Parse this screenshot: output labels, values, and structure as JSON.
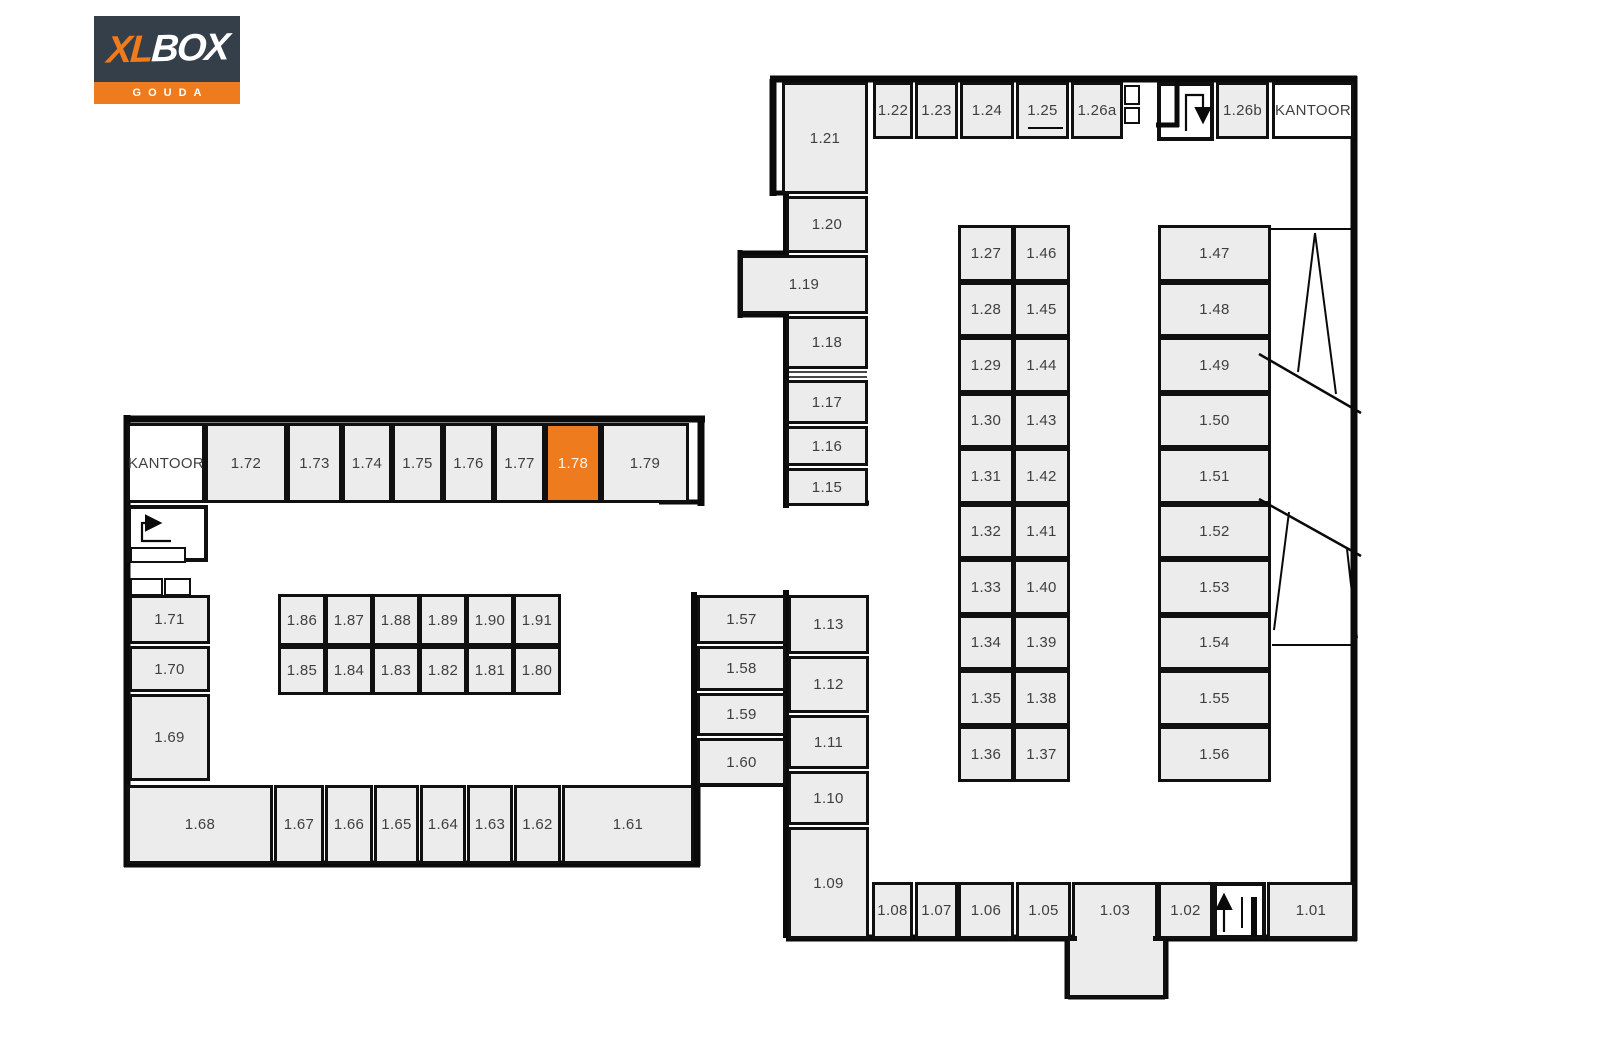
{
  "logo": {
    "xl": "XL",
    "box": "BOX",
    "city": "GOUDA"
  },
  "colors": {
    "highlight": "#ee7b1e",
    "unit_fill": "#ececec",
    "wall": "#0a0a0a",
    "logo_navy": "#353f4a",
    "label": "#3f3f3f"
  },
  "selected_unit": "1.78",
  "map": {
    "rooms": [
      {
        "label": "KANTOOR",
        "name": "kantoor-left",
        "x": 127,
        "y": 423,
        "w": 78,
        "h": 80,
        "fill": "office"
      },
      {
        "label": "1.72",
        "x": 205,
        "y": 423,
        "w": 82,
        "h": 80
      },
      {
        "label": "1.73",
        "x": 287,
        "y": 423,
        "w": 55,
        "h": 80
      },
      {
        "label": "1.74",
        "x": 342,
        "y": 423,
        "w": 50,
        "h": 80
      },
      {
        "label": "1.75",
        "x": 392,
        "y": 423,
        "w": 51,
        "h": 80
      },
      {
        "label": "1.76",
        "x": 443,
        "y": 423,
        "w": 51,
        "h": 80
      },
      {
        "label": "1.77",
        "x": 494,
        "y": 423,
        "w": 51,
        "h": 80
      },
      {
        "label": "1.78",
        "x": 545,
        "y": 423,
        "w": 56,
        "h": 80,
        "fill": "highlight"
      },
      {
        "label": "1.79",
        "x": 601,
        "y": 423,
        "w": 88,
        "h": 80
      },
      {
        "label": "",
        "name": "stairwell-left",
        "x": 127,
        "y": 505,
        "w": 81,
        "h": 57,
        "fill": "stair",
        "cls": "stairbox"
      },
      {
        "label": "",
        "name": "stair-landing-left",
        "x": 130,
        "y": 547,
        "w": 56,
        "h": 16,
        "fill": "stair",
        "cls": "thin"
      },
      {
        "label": "",
        "name": "closet-left-a",
        "x": 130,
        "y": 578,
        "w": 33,
        "h": 18,
        "fill": "stair",
        "cls": "thin"
      },
      {
        "label": "",
        "name": "closet-left-b",
        "x": 164,
        "y": 578,
        "w": 27,
        "h": 18,
        "fill": "stair",
        "cls": "thin"
      },
      {
        "label": "1.71",
        "x": 129,
        "y": 595,
        "w": 81,
        "h": 49
      },
      {
        "label": "1.70",
        "x": 129,
        "y": 646,
        "w": 81,
        "h": 46
      },
      {
        "label": "1.69",
        "x": 129,
        "y": 694,
        "w": 81,
        "h": 87
      },
      {
        "label": "1.68",
        "x": 127,
        "y": 785,
        "w": 146,
        "h": 79
      },
      {
        "label": "1.67",
        "x": 274,
        "y": 785,
        "w": 50,
        "h": 79
      },
      {
        "label": "1.66",
        "x": 325,
        "y": 785,
        "w": 48,
        "h": 79
      },
      {
        "label": "1.65",
        "x": 374,
        "y": 785,
        "w": 45,
        "h": 79
      },
      {
        "label": "1.64",
        "x": 420,
        "y": 785,
        "w": 46,
        "h": 79
      },
      {
        "label": "1.63",
        "x": 467,
        "y": 785,
        "w": 46,
        "h": 79
      },
      {
        "label": "1.62",
        "x": 514,
        "y": 785,
        "w": 47,
        "h": 79
      },
      {
        "label": "1.61",
        "x": 562,
        "y": 785,
        "w": 132,
        "h": 79
      },
      {
        "label": "1.86",
        "x": 278,
        "y": 594,
        "w": 48,
        "h": 52
      },
      {
        "label": "1.87",
        "x": 325,
        "y": 594,
        "w": 48,
        "h": 52
      },
      {
        "label": "1.88",
        "x": 372,
        "y": 594,
        "w": 48,
        "h": 52
      },
      {
        "label": "1.89",
        "x": 419,
        "y": 594,
        "w": 48,
        "h": 52
      },
      {
        "label": "1.90",
        "x": 466,
        "y": 594,
        "w": 48,
        "h": 52
      },
      {
        "label": "1.91",
        "x": 513,
        "y": 594,
        "w": 48,
        "h": 52
      },
      {
        "label": "1.85",
        "x": 278,
        "y": 646,
        "w": 48,
        "h": 49
      },
      {
        "label": "1.84",
        "x": 325,
        "y": 646,
        "w": 48,
        "h": 49
      },
      {
        "label": "1.83",
        "x": 372,
        "y": 646,
        "w": 48,
        "h": 49
      },
      {
        "label": "1.82",
        "x": 419,
        "y": 646,
        "w": 48,
        "h": 49
      },
      {
        "label": "1.81",
        "x": 466,
        "y": 646,
        "w": 48,
        "h": 49
      },
      {
        "label": "1.80",
        "x": 513,
        "y": 646,
        "w": 48,
        "h": 49
      },
      {
        "label": "1.57",
        "x": 697,
        "y": 595,
        "w": 89,
        "h": 49
      },
      {
        "label": "1.58",
        "x": 697,
        "y": 646,
        "w": 89,
        "h": 45
      },
      {
        "label": "1.59",
        "x": 697,
        "y": 693,
        "w": 89,
        "h": 43
      },
      {
        "label": "1.60",
        "x": 697,
        "y": 738,
        "w": 89,
        "h": 48
      },
      {
        "label": "1.13",
        "x": 788,
        "y": 595,
        "w": 81,
        "h": 59
      },
      {
        "label": "1.12",
        "x": 788,
        "y": 656,
        "w": 81,
        "h": 57
      },
      {
        "label": "1.11",
        "x": 788,
        "y": 715,
        "w": 81,
        "h": 54
      },
      {
        "label": "1.10",
        "x": 788,
        "y": 771,
        "w": 81,
        "h": 54
      },
      {
        "label": "1.09",
        "x": 788,
        "y": 827,
        "w": 81,
        "h": 112
      },
      {
        "label": "1.21",
        "x": 782,
        "y": 82,
        "w": 86,
        "h": 112
      },
      {
        "label": "1.20",
        "x": 786,
        "y": 196,
        "w": 82,
        "h": 57
      },
      {
        "label": "1.19",
        "x": 740,
        "y": 255,
        "w": 128,
        "h": 59
      },
      {
        "label": "1.18",
        "x": 786,
        "y": 316,
        "w": 82,
        "h": 53
      },
      {
        "label": "1.17",
        "x": 786,
        "y": 380,
        "w": 82,
        "h": 44
      },
      {
        "label": "1.16",
        "x": 786,
        "y": 426,
        "w": 82,
        "h": 40
      },
      {
        "label": "1.15",
        "x": 786,
        "y": 468,
        "w": 82,
        "h": 38
      },
      {
        "label": "1.22",
        "x": 873,
        "y": 82,
        "w": 40,
        "h": 57
      },
      {
        "label": "1.23",
        "x": 915,
        "y": 82,
        "w": 43,
        "h": 57
      },
      {
        "label": "1.24",
        "x": 960,
        "y": 82,
        "w": 54,
        "h": 57
      },
      {
        "label": "1.25",
        "x": 1016,
        "y": 82,
        "w": 53,
        "h": 57
      },
      {
        "label": "1.26a",
        "x": 1071,
        "y": 82,
        "w": 52,
        "h": 57
      },
      {
        "label": "",
        "name": "shaft-top-a",
        "x": 1124,
        "y": 85,
        "w": 16,
        "h": 20,
        "fill": "stair",
        "cls": "thin"
      },
      {
        "label": "",
        "name": "shaft-top-b",
        "x": 1124,
        "y": 107,
        "w": 16,
        "h": 17,
        "fill": "stair",
        "cls": "thin"
      },
      {
        "label": "",
        "name": "stairwell-top",
        "x": 1157,
        "y": 82,
        "w": 57,
        "h": 59,
        "fill": "stair",
        "cls": "stairbox"
      },
      {
        "label": "1.26b",
        "x": 1216,
        "y": 82,
        "w": 53,
        "h": 57
      },
      {
        "label": "KANTOOR",
        "name": "kantoor-right",
        "x": 1272,
        "y": 82,
        "w": 82,
        "h": 57,
        "fill": "office"
      },
      {
        "label": "1.27",
        "x": 958,
        "y": 225,
        "w": 56,
        "h": 57
      },
      {
        "label": "1.28",
        "x": 958,
        "y": 282,
        "w": 56,
        "h": 55
      },
      {
        "label": "1.29",
        "x": 958,
        "y": 337,
        "w": 56,
        "h": 56
      },
      {
        "label": "1.30",
        "x": 958,
        "y": 393,
        "w": 56,
        "h": 55
      },
      {
        "label": "1.31",
        "x": 958,
        "y": 448,
        "w": 56,
        "h": 56
      },
      {
        "label": "1.32",
        "x": 958,
        "y": 504,
        "w": 56,
        "h": 55
      },
      {
        "label": "1.33",
        "x": 958,
        "y": 559,
        "w": 56,
        "h": 56
      },
      {
        "label": "1.34",
        "x": 958,
        "y": 615,
        "w": 56,
        "h": 55
      },
      {
        "label": "1.35",
        "x": 958,
        "y": 670,
        "w": 56,
        "h": 56
      },
      {
        "label": "1.36",
        "x": 958,
        "y": 726,
        "w": 56,
        "h": 56
      },
      {
        "label": "1.46",
        "x": 1013,
        "y": 225,
        "w": 57,
        "h": 57
      },
      {
        "label": "1.45",
        "x": 1013,
        "y": 282,
        "w": 57,
        "h": 55
      },
      {
        "label": "1.44",
        "x": 1013,
        "y": 337,
        "w": 57,
        "h": 56
      },
      {
        "label": "1.43",
        "x": 1013,
        "y": 393,
        "w": 57,
        "h": 55
      },
      {
        "label": "1.42",
        "x": 1013,
        "y": 448,
        "w": 57,
        "h": 56
      },
      {
        "label": "1.41",
        "x": 1013,
        "y": 504,
        "w": 57,
        "h": 55
      },
      {
        "label": "1.40",
        "x": 1013,
        "y": 559,
        "w": 57,
        "h": 56
      },
      {
        "label": "1.39",
        "x": 1013,
        "y": 615,
        "w": 57,
        "h": 55
      },
      {
        "label": "1.38",
        "x": 1013,
        "y": 670,
        "w": 57,
        "h": 56
      },
      {
        "label": "1.37",
        "x": 1013,
        "y": 726,
        "w": 57,
        "h": 56
      },
      {
        "label": "1.47",
        "x": 1158,
        "y": 225,
        "w": 113,
        "h": 57
      },
      {
        "label": "1.48",
        "x": 1158,
        "y": 282,
        "w": 113,
        "h": 55
      },
      {
        "label": "1.49",
        "x": 1158,
        "y": 337,
        "w": 113,
        "h": 56
      },
      {
        "label": "1.50",
        "x": 1158,
        "y": 393,
        "w": 113,
        "h": 55
      },
      {
        "label": "1.51",
        "x": 1158,
        "y": 448,
        "w": 113,
        "h": 56
      },
      {
        "label": "1.52",
        "x": 1158,
        "y": 504,
        "w": 113,
        "h": 55
      },
      {
        "label": "1.53",
        "x": 1158,
        "y": 559,
        "w": 113,
        "h": 56
      },
      {
        "label": "1.54",
        "x": 1158,
        "y": 615,
        "w": 113,
        "h": 55
      },
      {
        "label": "1.55",
        "x": 1158,
        "y": 670,
        "w": 113,
        "h": 56
      },
      {
        "label": "1.56",
        "x": 1158,
        "y": 726,
        "w": 113,
        "h": 56
      },
      {
        "label": "1.08",
        "x": 872,
        "y": 882,
        "w": 41,
        "h": 57
      },
      {
        "label": "1.07",
        "x": 915,
        "y": 882,
        "w": 43,
        "h": 57
      },
      {
        "label": "1.06",
        "x": 958,
        "y": 882,
        "w": 56,
        "h": 57
      },
      {
        "label": "1.05",
        "x": 1016,
        "y": 882,
        "w": 55,
        "h": 57
      },
      {
        "label": "",
        "name": "room-1-03-annex",
        "x": 1067,
        "y": 938,
        "w": 99,
        "h": 60
      },
      {
        "label": "1.03",
        "x": 1072,
        "y": 882,
        "w": 86,
        "h": 57
      },
      {
        "label": "",
        "name": "room-1-03-join",
        "x": 1077,
        "y": 930,
        "w": 76,
        "h": 14,
        "fill": "patch",
        "cls": "patch"
      },
      {
        "label": "1.02",
        "x": 1158,
        "y": 882,
        "w": 55,
        "h": 57
      },
      {
        "label": "",
        "name": "stairwell-bottom",
        "x": 1213,
        "y": 882,
        "w": 53,
        "h": 57,
        "fill": "stair",
        "cls": "stairbox"
      },
      {
        "label": "1.01",
        "x": 1267,
        "y": 882,
        "w": 88,
        "h": 57
      }
    ],
    "walls": [
      [
        127,
        419,
        705,
        419,
        7
      ],
      [
        127,
        415,
        127,
        867,
        7
      ],
      [
        124,
        864,
        700,
        864,
        7
      ],
      [
        701,
        419,
        701,
        506,
        7
      ],
      [
        659,
        502,
        703,
        502,
        5
      ],
      [
        697,
        782,
        697,
        866,
        7
      ],
      [
        694,
        592,
        694,
        787,
        6
      ],
      [
        693,
        784,
        789,
        784,
        6
      ],
      [
        770,
        79,
        1357,
        79,
        7
      ],
      [
        1354,
        76,
        1354,
        941,
        7
      ],
      [
        786,
        938,
        1357,
        938,
        7
      ],
      [
        1068,
        936,
        1068,
        999,
        7
      ],
      [
        1068,
        996,
        1165,
        996,
        7
      ],
      [
        1165,
        936,
        1165,
        999,
        7
      ],
      [
        773,
        79,
        773,
        196,
        7
      ],
      [
        772,
        193,
        788,
        193,
        5
      ],
      [
        786,
        190,
        786,
        508,
        6
      ],
      [
        786,
        590,
        786,
        938,
        6
      ],
      [
        740,
        253,
        786,
        253,
        5
      ],
      [
        740,
        250,
        740,
        318,
        5
      ],
      [
        740,
        315,
        786,
        315,
        5
      ],
      [
        786,
        503,
        869,
        503,
        5
      ]
    ],
    "overlay_lines": [
      [
        787,
        372,
        867,
        372,
        1.6
      ],
      [
        787,
        377,
        867,
        377,
        1.6
      ],
      [
        1028,
        128,
        1063,
        128,
        2
      ],
      [
        1271,
        229,
        1353,
        229,
        2
      ],
      [
        1315,
        233,
        1298,
        372,
        2
      ],
      [
        1315,
        233,
        1336,
        394,
        2
      ],
      [
        1259,
        354,
        1361,
        413,
        2.5
      ],
      [
        1259,
        499,
        1361,
        556,
        2.5
      ],
      [
        1289,
        512,
        1274,
        630,
        2
      ],
      [
        1347,
        549,
        1357,
        638,
        2
      ],
      [
        1272,
        645,
        1354,
        645,
        2
      ],
      [
        1177,
        82,
        1177,
        127,
        5
      ],
      [
        1156,
        125,
        1179,
        125,
        5
      ],
      [
        1254,
        897,
        1254,
        937,
        6
      ],
      [
        1242,
        897,
        1242,
        928,
        2
      ]
    ],
    "arrows": [
      {
        "name": "stair-arrow-right",
        "pts": [
          [
            171,
            541
          ],
          [
            142,
            541
          ],
          [
            142,
            523
          ],
          [
            158,
            523
          ]
        ]
      },
      {
        "name": "stair-arrow-down",
        "pts": [
          [
            1186,
            131
          ],
          [
            1186,
            95
          ],
          [
            1203,
            95
          ],
          [
            1203,
            120
          ]
        ]
      },
      {
        "name": "stair-arrow-up",
        "pts": [
          [
            1224,
            932
          ],
          [
            1224,
            897
          ]
        ]
      }
    ]
  }
}
